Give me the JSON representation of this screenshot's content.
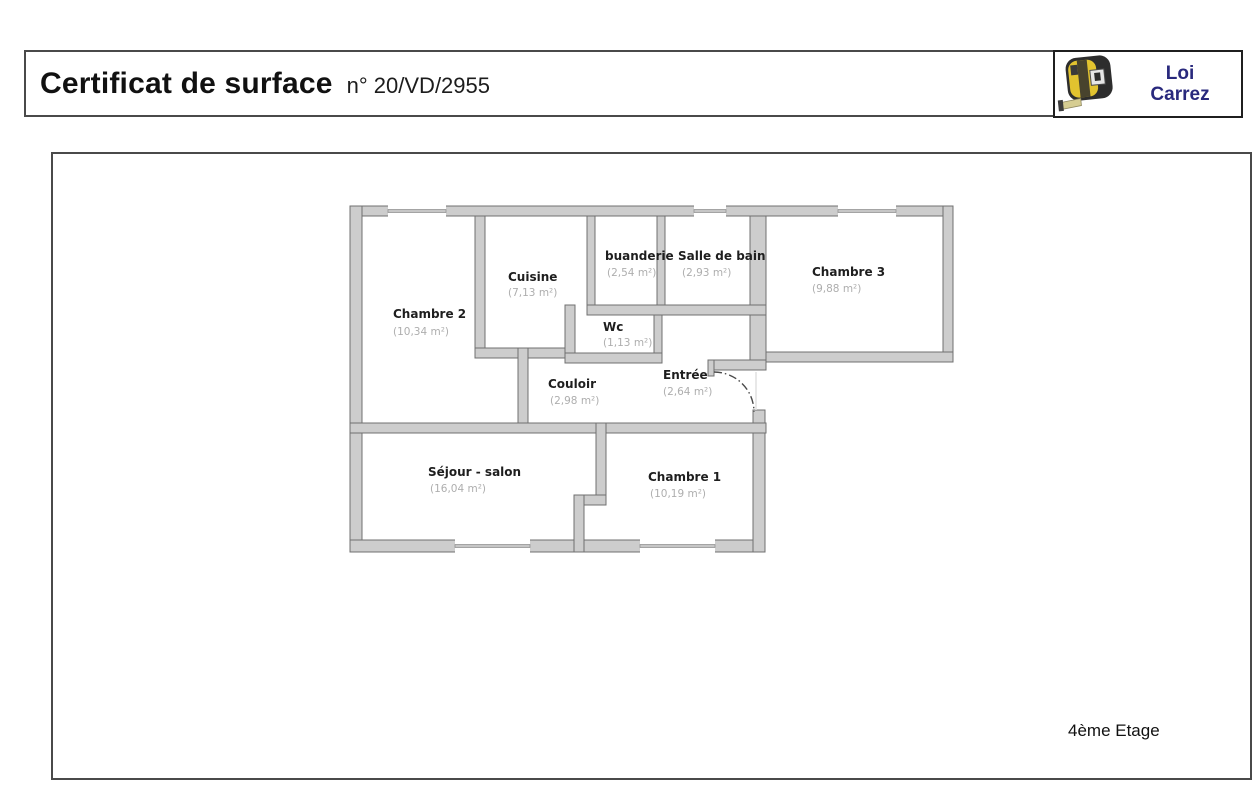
{
  "header": {
    "title": "Certificat de surface",
    "number": "n° 20/VD/2955"
  },
  "logo": {
    "line1": "Loi",
    "line2": "Carrez",
    "text_color": "#29297d",
    "icon": "tape-measure-icon"
  },
  "plan": {
    "floor_label": "4ème Etage",
    "wall_color": "#cdcdcd",
    "wall_outline_color": "#707070",
    "room_name_color": "#1e1e1e",
    "room_area_color": "#aeaeae",
    "rooms": [
      {
        "name": "Chambre 2",
        "area": "(10,34 m²)"
      },
      {
        "name": "Cuisine",
        "area": "(7,13 m²)"
      },
      {
        "name": "buanderie",
        "area": "(2,54 m²)"
      },
      {
        "name": "Salle de bain",
        "area": "(2,93 m²)"
      },
      {
        "name": "Chambre 3",
        "area": "(9,88 m²)"
      },
      {
        "name": "Wc",
        "area": "(1,13 m²)"
      },
      {
        "name": "Couloir",
        "area": "(2,98 m²)"
      },
      {
        "name": "Entrée",
        "area": "(2,64 m²)"
      },
      {
        "name": "Séjour - salon",
        "area": "(16,04 m²)"
      },
      {
        "name": "Chambre 1",
        "area": "(10,19 m²)"
      }
    ]
  }
}
